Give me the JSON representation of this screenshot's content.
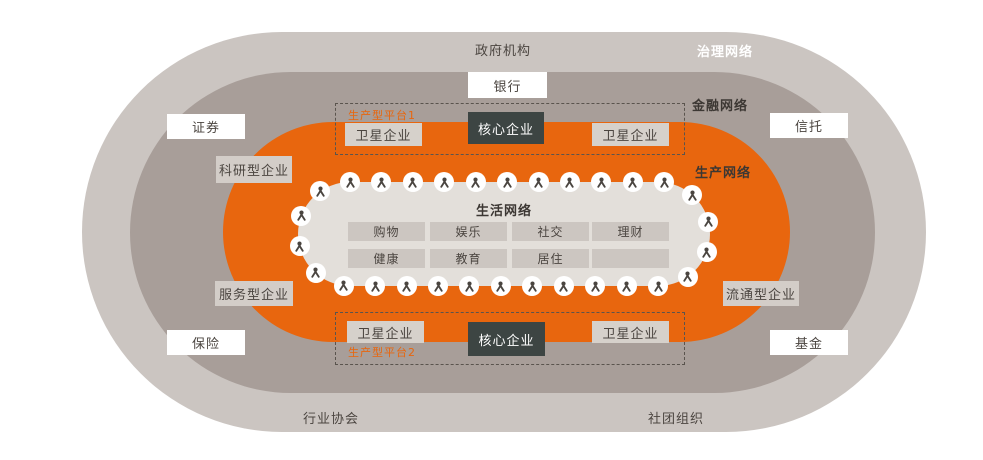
{
  "colors": {
    "governance_ring": "#cbc5c1",
    "finance_ring": "#a89e99",
    "production_ring": "#e8660e",
    "life_ring": "#e3dfda",
    "core_box": "#3d4543",
    "accent_orange": "#e8660e",
    "text_dark": "#4b4540"
  },
  "networks": {
    "governance": "治理网络",
    "finance": "金融网络",
    "production": "生产网络",
    "life": "生活网络"
  },
  "governance": {
    "top": "政府机构",
    "bottom_left": "行业协会",
    "bottom_right": "社团组织"
  },
  "finance": {
    "bank": "银行",
    "securities": "证券",
    "trust": "信托",
    "insurance": "保险",
    "fund": "基金"
  },
  "production": {
    "research": "科研型企业",
    "service": "服务型企业",
    "circulation": "流通型企业",
    "platform1": {
      "label": "生产型平台1",
      "satellite_left": "卫星企业",
      "core": "核心企业",
      "satellite_right": "卫星企业"
    },
    "platform2": {
      "label": "生产型平台2",
      "satellite_left": "卫星企业",
      "core": "核心企业",
      "satellite_right": "卫星企业"
    }
  },
  "life_network": {
    "title": "生活网络",
    "items": [
      "购物",
      "娱乐",
      "社交",
      "理财",
      "健康",
      "教育",
      "居住",
      ""
    ],
    "person_icon_count": 30
  }
}
